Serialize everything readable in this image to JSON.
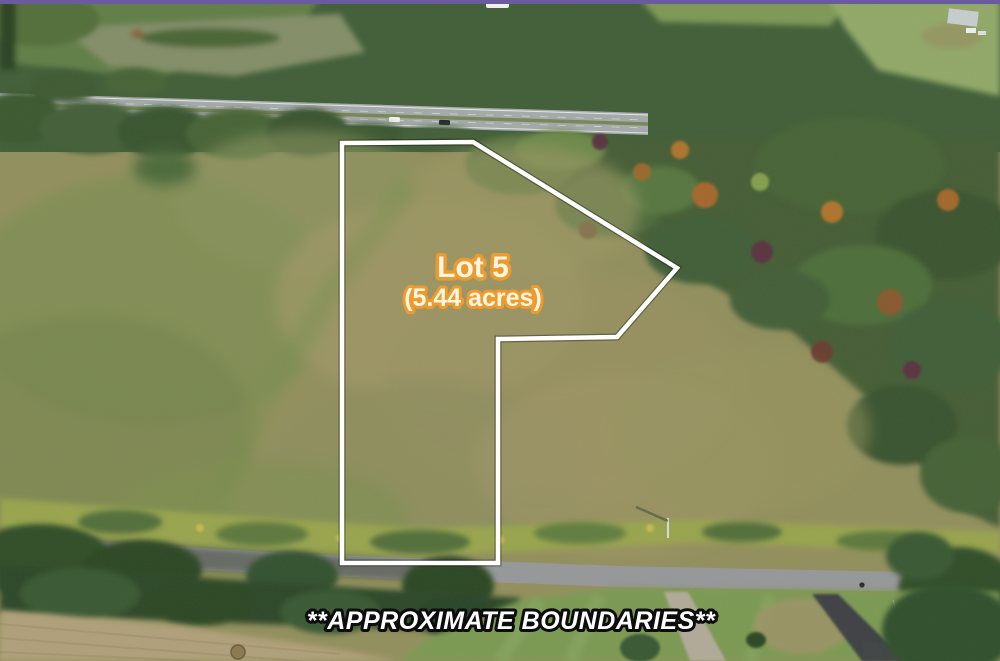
{
  "annotations": {
    "lot_name": "Lot 5",
    "lot_area": "(5.44 acres)",
    "disclaimer": "**APPROXIMATE BOUNDARIES**"
  },
  "colors": {
    "boundary_line": "#ffffff",
    "lot_label_fill": "#fdf6e3",
    "lot_label_outline": "#ee9b2e",
    "disclaimer_fill": "#ffffff",
    "disclaimer_outline": "#0d0d0d"
  }
}
